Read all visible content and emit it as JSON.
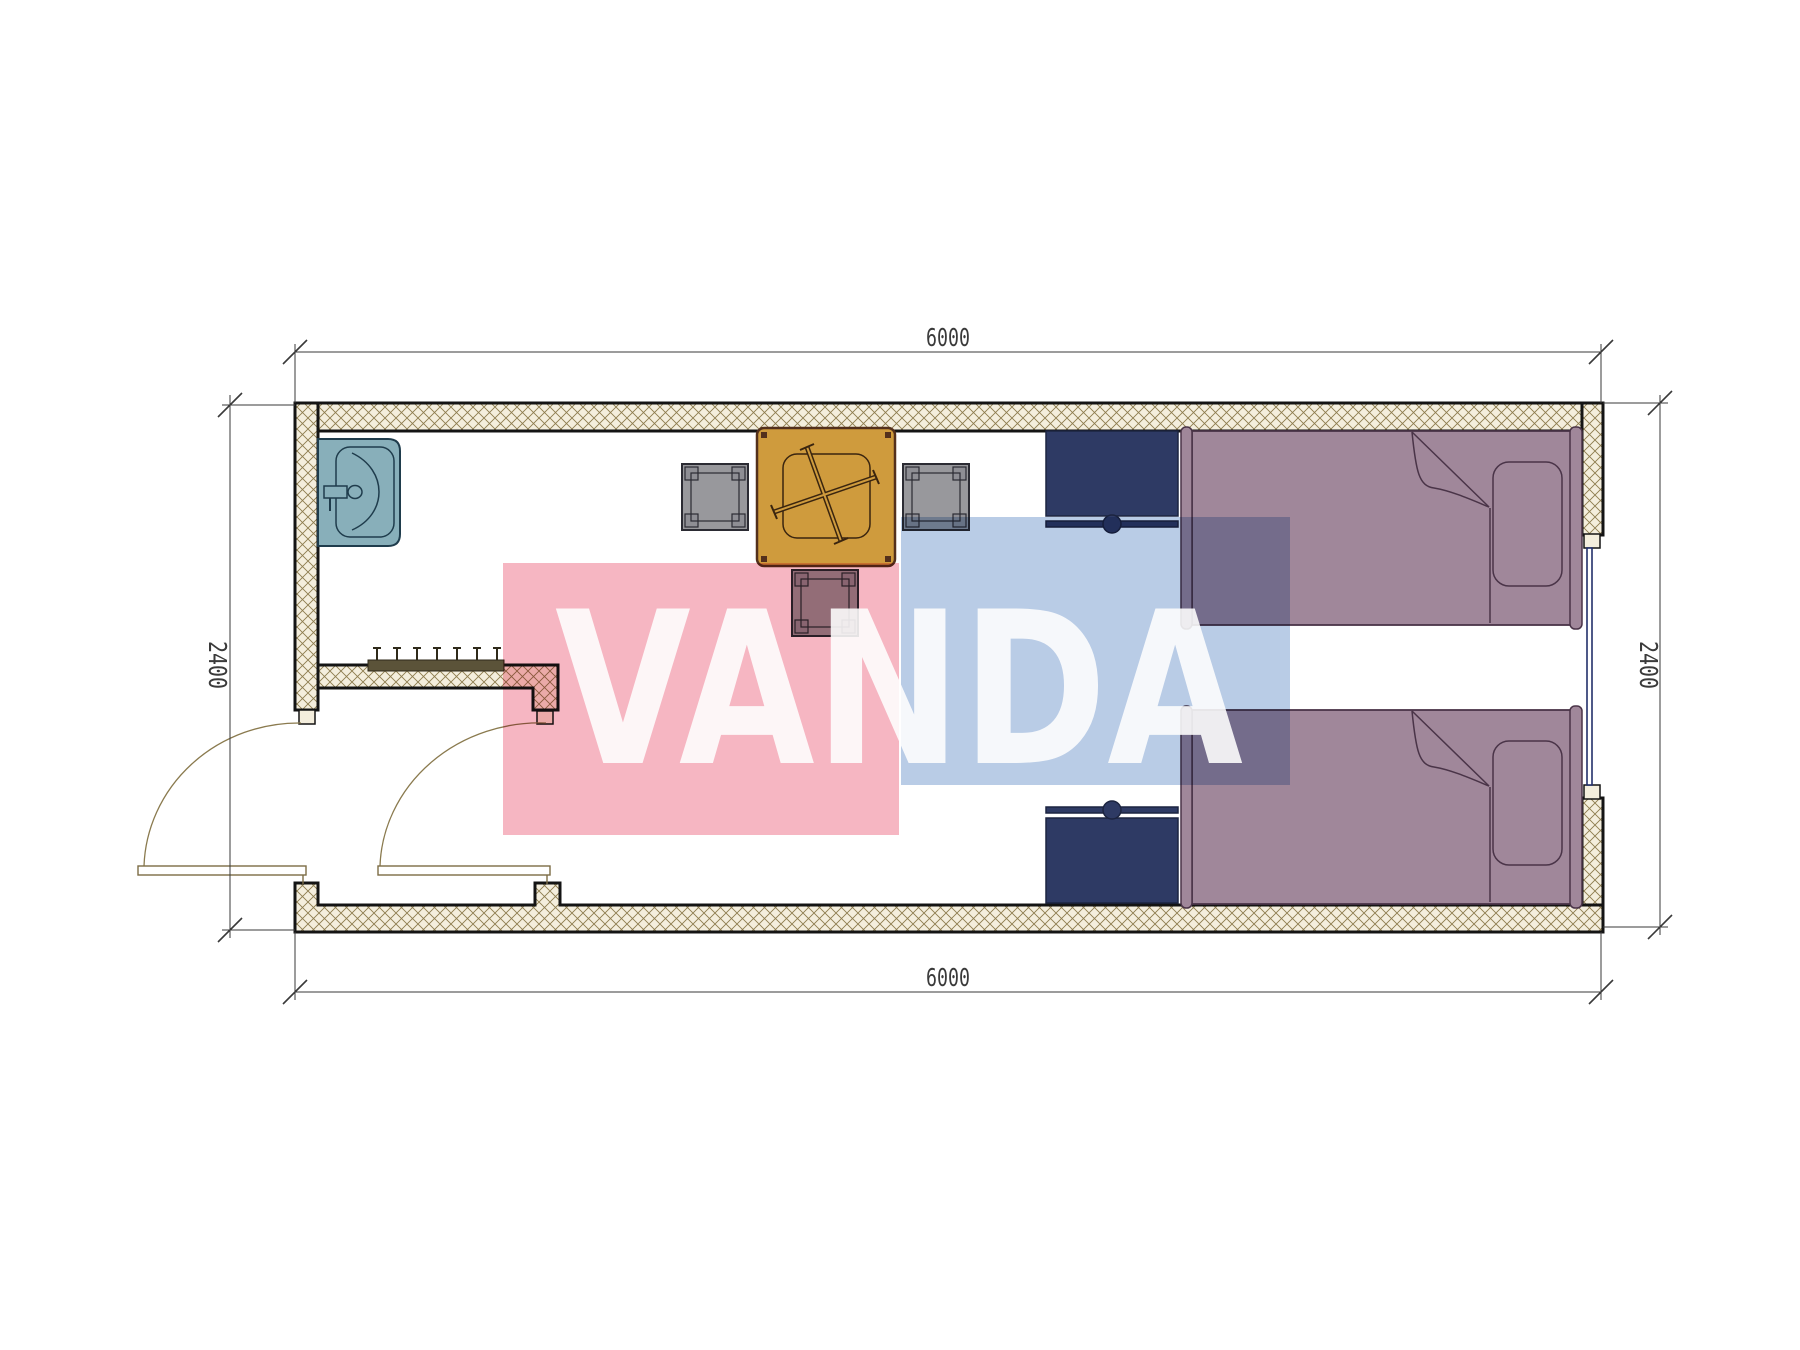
{
  "plan": {
    "dim_top": "6000",
    "dim_bottom": "6000",
    "dim_left": "2400",
    "dim_right": "2400"
  },
  "watermark": {
    "text": "VANDA"
  },
  "colors": {
    "page": "#ffffff",
    "wall-fill": "#f4eedd",
    "wall-hatch": "#8d7c4e",
    "wall-edge": "#141414",
    "dim": "#3a3a3a",
    "door": "#8a7a4e",
    "leaf": "#7c6c45",
    "table": "#cf9b3d",
    "table-edge": "#53301c",
    "table-detail": "#3a250f",
    "chair": "#98989c",
    "chair-alt": "#8e8e94",
    "chair-edge": "#2b2b33",
    "sink": "#88afba",
    "sink-edge": "#1f3c4c",
    "bed": "#a0879a",
    "bed-edge": "#4a3448",
    "nightstand": "#2e3a64",
    "nightstand-edge": "#1c2440",
    "window": "#23306b",
    "rack": "#5b5339",
    "rack-edge": "#2f2a1a",
    "wm-pink": "#f6b6c2",
    "wm-blue": "#b9cce6",
    "wm-text": "#ffffff"
  }
}
